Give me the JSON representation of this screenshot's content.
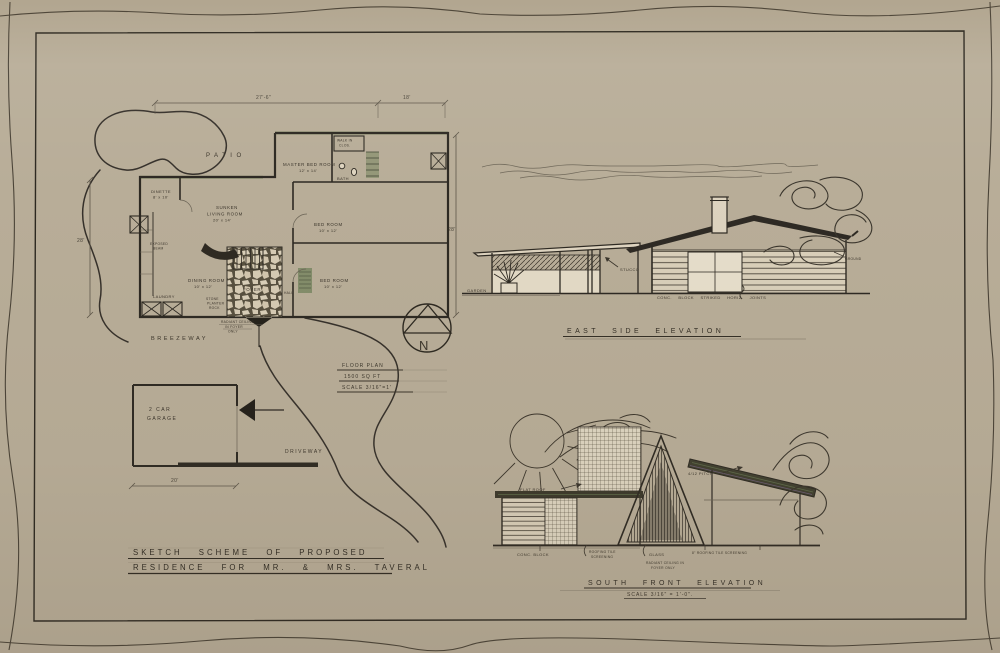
{
  "compass": {
    "letter": "N"
  },
  "title_block": {
    "line1": "SKETCH SCHEME OF PROPOSED",
    "line2": "RESIDENCE FOR MR. & MRS. TAVERAL"
  },
  "floor_plan": {
    "caption": {
      "title": "FLOOR PLAN",
      "area": "1500 SQ FT",
      "scale": "SCALE 3/16\"=1'"
    },
    "dimensions": {
      "top_left": "27'-6\"",
      "top_right": "18'",
      "side_left": "28'",
      "side_right": "28'",
      "garage_width": "20'"
    },
    "rooms": {
      "patio": "PATIO",
      "master_bedroom": "MASTER BED ROOM",
      "master_bedroom_size": "12' x 14'",
      "walk_in_closet_1": "WALK IN",
      "walk_in_closet_2": "CLOS.",
      "bath": "BATH",
      "dinette": "DINETTE",
      "dinette_size": "8' x 10'",
      "living_1": "SUNKEN",
      "living_2": "LIVING ROOM",
      "living_size": "20' x 14'",
      "bedroom_upper": "BED ROOM",
      "bedroom_upper_size": "10' x 12'",
      "dining": "DINING ROOM",
      "dining_size": "10' x 12'",
      "foyer": "FOYER",
      "hall": "HALL",
      "laundry": "LAUNDRY",
      "bedroom_lower": "BED ROOM",
      "bedroom_lower_size": "10' x 12'",
      "breezeway": "BREEZEWAY",
      "garage_1": "2 CAR",
      "garage_2": "GARAGE",
      "driveway": "DRIVEWAY"
    },
    "notes": {
      "exposed_1": "EXPOSED",
      "exposed_2": "BEAM",
      "planter_1": "STONE",
      "planter_2": "PLANTER",
      "planter_3": "ROCK",
      "radiant_1": "RADIANT CEILING",
      "radiant_2": "IN FOYER",
      "radiant_3": "ONLY"
    }
  },
  "east_elevation": {
    "title": "EAST SIDE ELEVATION",
    "labels": {
      "garden": "GARDEN",
      "stucco": "STUCCO",
      "ground": "GROUND",
      "wall_note": "CONC. BLOCK STRIKED HORIZ. JOINTS"
    }
  },
  "south_elevation": {
    "title": "SOUTH FRONT ELEVATION",
    "scale_note": "SCALE 3/16\" = 1'-0\".",
    "labels": {
      "flat_roof": "FLAT ROOF",
      "pitch": "4/12 PITCH",
      "conc_block": "CONC. BLOCK",
      "screening_1": "ROOFING TILE",
      "screening_2": "SCREENING",
      "glass": "GLASS",
      "screening_8": "8\" ROOFING TILE SCREENING",
      "radiant_1": "RADIANT CEILING IN",
      "radiant_2": "FOYER ONLY"
    }
  }
}
